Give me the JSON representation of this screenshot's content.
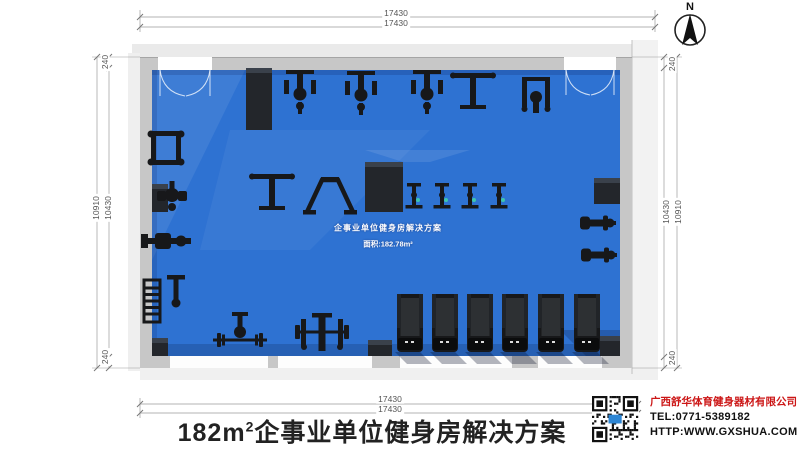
{
  "title": {
    "prefix": "182m",
    "sup": "2",
    "suffix": "企事业单位健身房解决方案"
  },
  "compass": {
    "label": "N"
  },
  "dimensions": {
    "top": [
      "17430",
      "17430"
    ],
    "bottom": [
      "17430",
      "17430"
    ],
    "left": {
      "outer": "10910",
      "inner": "10430",
      "wall_top": "240",
      "wall_bottom": "240"
    },
    "right": {
      "outer": "10910",
      "inner": "10430",
      "wall_top": "240",
      "wall_bottom": "240"
    }
  },
  "floor_label": {
    "line1": "企事业单位健身房解决方案",
    "line2": "面积:182.78m²"
  },
  "company": {
    "name": "广西舒华体育健身器材有限公司",
    "tel": "TEL:0771-5389182",
    "website": "HTTP:WWW.GXSHUA.COM"
  },
  "colors": {
    "floor": "#2E72D2",
    "floor_light": "#3F82DF",
    "floor_shadow": "#1F4F9E",
    "wall": "#C7C7C7",
    "wall_face": "#EAEAEA",
    "equipment": "#17181A",
    "column": "#23262B",
    "company_red": "#CC1616",
    "dim_line": "#8A8A8A"
  },
  "columns": [
    {
      "x": 246,
      "y": 68,
      "w": 26,
      "h": 62
    },
    {
      "x": 365,
      "y": 162,
      "w": 38,
      "h": 50
    },
    {
      "x": 594,
      "y": 178,
      "w": 26,
      "h": 26
    },
    {
      "x": 152,
      "y": 184,
      "w": 16,
      "h": 28
    },
    {
      "x": 368,
      "y": 340,
      "w": 24,
      "h": 16
    },
    {
      "x": 600,
      "y": 336,
      "w": 20,
      "h": 20
    },
    {
      "x": 152,
      "y": 338,
      "w": 16,
      "h": 18
    }
  ],
  "equipment": [
    {
      "name": "strength-machine-1",
      "type": "trainer",
      "x": 300,
      "y": 96
    },
    {
      "name": "strength-machine-2",
      "type": "trainer",
      "x": 361,
      "y": 97
    },
    {
      "name": "strength-machine-3",
      "type": "trainer",
      "x": 427,
      "y": 96
    },
    {
      "name": "strength-machine-4",
      "type": "tbar",
      "x": 473,
      "y": 95
    },
    {
      "name": "strength-machine-5",
      "type": "walker",
      "x": 536,
      "y": 97
    },
    {
      "name": "squat-rack",
      "type": "squat",
      "x": 166,
      "y": 148
    },
    {
      "name": "pec-deck-machine",
      "type": "pec",
      "x": 172,
      "y": 197
    },
    {
      "name": "rowing-bench",
      "type": "row",
      "x": 165,
      "y": 241
    },
    {
      "name": "dumbbell-rack",
      "type": "ladder",
      "x": 152,
      "y": 301
    },
    {
      "name": "flat-bench",
      "type": "bench",
      "x": 176,
      "y": 291
    },
    {
      "name": "t-bar-machine",
      "type": "tbar",
      "x": 272,
      "y": 196
    },
    {
      "name": "power-frame",
      "type": "frame",
      "x": 330,
      "y": 196
    },
    {
      "name": "spin-bike-1",
      "type": "spin",
      "x": 414,
      "y": 198
    },
    {
      "name": "spin-bike-2",
      "type": "spin",
      "x": 442,
      "y": 198
    },
    {
      "name": "spin-bike-3",
      "type": "spin",
      "x": 470,
      "y": 198
    },
    {
      "name": "spin-bike-4",
      "type": "spin",
      "x": 499,
      "y": 198
    },
    {
      "name": "exercise-bike-1",
      "type": "bike",
      "x": 597,
      "y": 223
    },
    {
      "name": "exercise-bike-2",
      "type": "bike",
      "x": 598,
      "y": 255
    },
    {
      "name": "barbell-station",
      "type": "barbell",
      "x": 240,
      "y": 340
    },
    {
      "name": "bench-press-station",
      "type": "press",
      "x": 322,
      "y": 334
    },
    {
      "name": "treadmill-1",
      "type": "treadmill",
      "x": 410,
      "y": 324
    },
    {
      "name": "treadmill-2",
      "type": "treadmill",
      "x": 445,
      "y": 324
    },
    {
      "name": "treadmill-3",
      "type": "treadmill",
      "x": 480,
      "y": 324
    },
    {
      "name": "treadmill-4",
      "type": "treadmill",
      "x": 515,
      "y": 324
    },
    {
      "name": "treadmill-5",
      "type": "treadmill",
      "x": 551,
      "y": 324
    },
    {
      "name": "treadmill-6",
      "type": "treadmill",
      "x": 587,
      "y": 324
    }
  ]
}
